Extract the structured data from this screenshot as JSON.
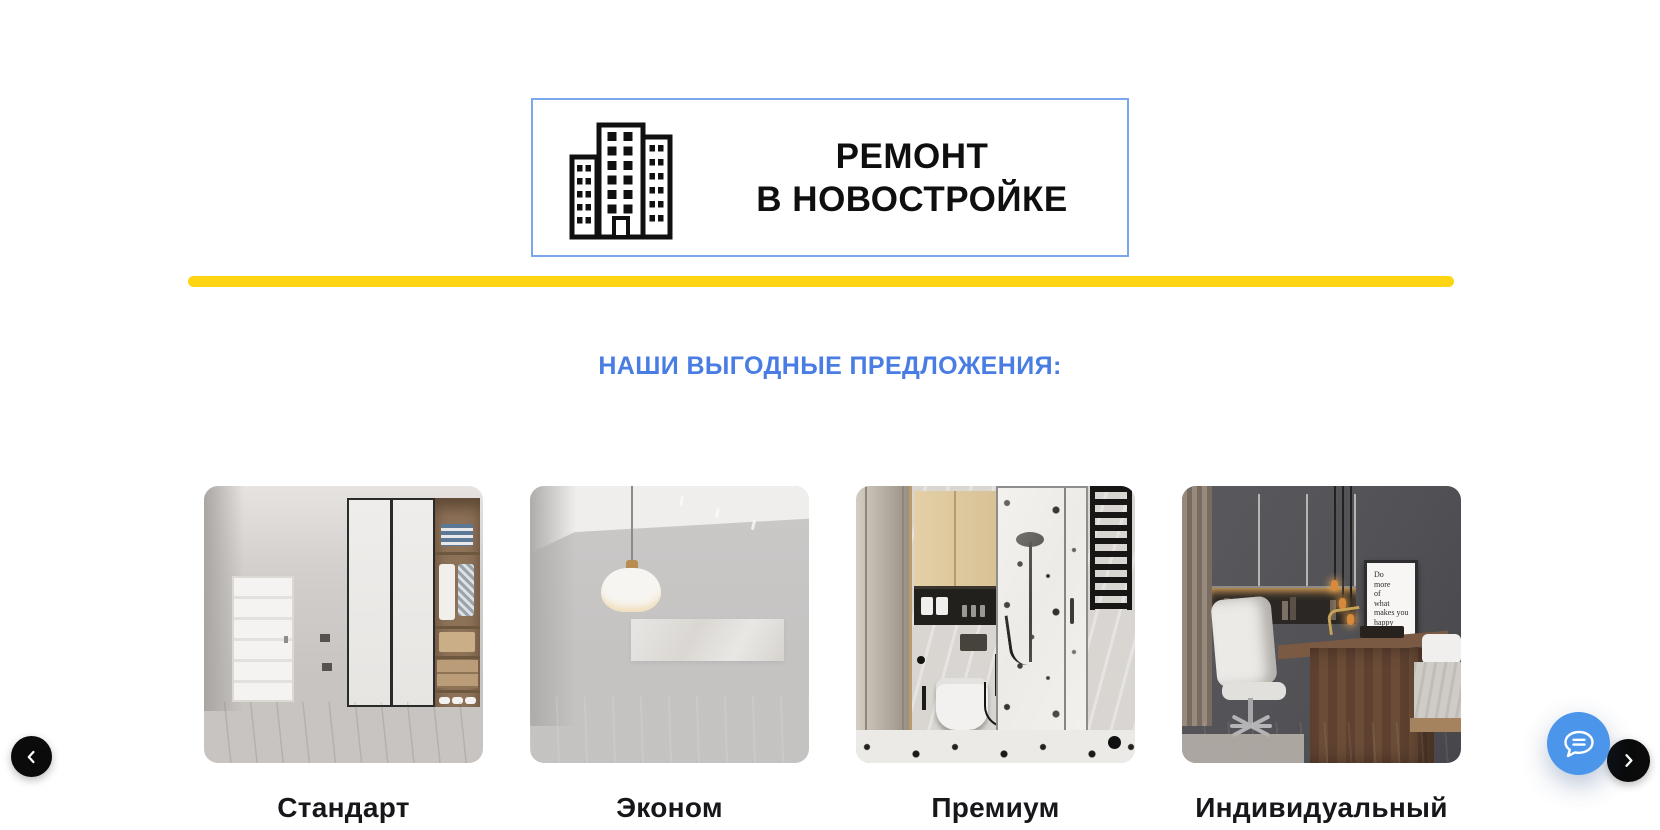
{
  "page": {
    "background": "#ffffff"
  },
  "logo": {
    "title_line1": "РЕМОНТ",
    "title_line2": "В НОВОСТРОЙКЕ",
    "border_color": "#7BA7EC",
    "icon": "building-icon",
    "text_color": "#0f0f10"
  },
  "divider": {
    "color": "#FFD412"
  },
  "heading": {
    "text": "НАШИ ВЫГОДНЫЕ ПРЕДЛОЖЕНИЯ:",
    "color": "#4A7DE3"
  },
  "offers": [
    {
      "label": "Стандарт",
      "image": "standard-hallway-photo"
    },
    {
      "label": "Эконом",
      "image": "econom-empty-room-photo"
    },
    {
      "label": "Премиум",
      "image": "premium-bathroom-photo"
    },
    {
      "label": "Индивидуальный",
      "image": "individual-office-photo"
    }
  ],
  "offer4_poster": {
    "text": "Do\nmore\nof\nwhat\nmakes you\nhappy"
  },
  "carousel": {
    "prev_icon": "chevron-left-icon",
    "next_icon": "chevron-right-icon"
  },
  "chat_widget": {
    "icon": "chat-bubble-icon",
    "color": "#4B95EA"
  }
}
